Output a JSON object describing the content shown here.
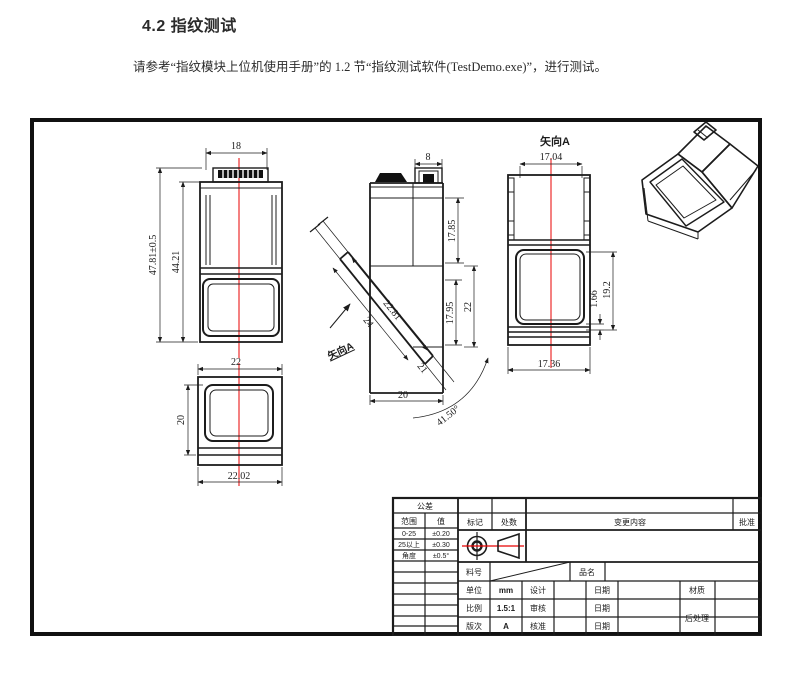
{
  "page": {
    "heading": "4.2  指纹测试",
    "body": "请参考“指纹模块上位机使用手册”的 1.2 节“指纹测试软件(TestDemo.exe)”，进行测试。"
  },
  "colors": {
    "line": "#1c1c1c",
    "centerline": "#e80000"
  },
  "views": {
    "front": {
      "width_top": "18",
      "height_outer": "47.81±0.5",
      "height_inner": "44.21"
    },
    "bottom": {
      "width_top": "22",
      "height_left": "20",
      "width_bottom": "22.02"
    },
    "side": {
      "connector_width": "8",
      "upper_height": "17.85",
      "lower_height": "17.95",
      "total_height": "22",
      "face_length_inner": "22.81",
      "face_length_outer": "24",
      "face_end": "21",
      "bottom_width": "20",
      "angle": "41.50°",
      "view_arrow": "矢向A"
    },
    "rear": {
      "view_label": "矢向A",
      "width_top": "17.04",
      "window_offset": "1.66",
      "window_height": "19.2",
      "width_bottom": "17.36"
    }
  },
  "title_block": {
    "tolerance": {
      "header": "公差",
      "col_range": "范围",
      "col_value": "值",
      "rows": [
        {
          "range": "0-25",
          "value": "±0.20"
        },
        {
          "range": "25以上",
          "value": "±0.30"
        },
        {
          "range": "角度",
          "value": "±0.5°"
        }
      ]
    },
    "revision": {
      "mark": "标记",
      "count": "处数",
      "content": "变更内容",
      "approve": "批准"
    },
    "fields": {
      "part_no": "料号",
      "product_name": "品名",
      "unit": "单位",
      "unit_value": "mm",
      "design": "设计",
      "date1": "日期",
      "material": "材质",
      "scale": "比例",
      "scale_value": "1.5:1",
      "review": "审核",
      "date2": "日期",
      "post": "后处理",
      "version": "版次",
      "version_value": "A",
      "check": "核准",
      "date3": "日期"
    }
  }
}
